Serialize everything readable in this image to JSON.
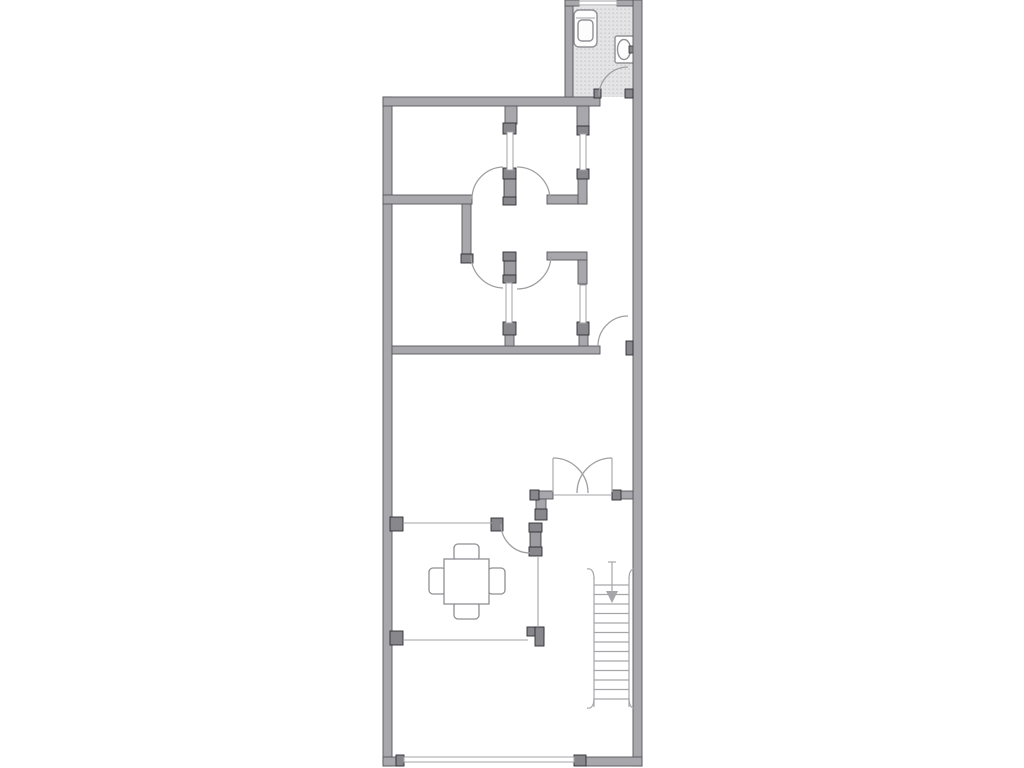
{
  "canvas": {
    "width": 1024,
    "height": 768,
    "background": "#ffffff"
  },
  "palette": {
    "wall": "#a8a8ac",
    "wall_outline": "#56565c",
    "jamb": "#87878c",
    "jamb_outline": "#2e2e33",
    "leaf": "#9c9ca1",
    "thin": "#a3a3a7",
    "arc": "#a0a0a4",
    "stair": "#a6a6aa",
    "fixture": "#909095",
    "fixture_fill": "#fdfdfe",
    "floor": "#e4e4e7",
    "floor_dot": "#c9c9cc"
  },
  "floor_plan": {
    "walls": [
      {
        "name": "exterior-wall-left",
        "x": 383,
        "y": 97,
        "w": 9,
        "h": 669
      },
      {
        "name": "exterior-wall-top",
        "x": 383,
        "y": 97,
        "w": 217,
        "h": 9
      },
      {
        "name": "exterior-wall-right",
        "x": 633,
        "y": 0,
        "w": 9,
        "h": 766
      },
      {
        "name": "exterior-wall-bottom-left",
        "x": 383,
        "y": 757,
        "w": 20,
        "h": 9
      },
      {
        "name": "exterior-wall-bottom-right",
        "x": 585,
        "y": 757,
        "w": 57,
        "h": 9
      },
      {
        "name": "bathroom-wall-left",
        "x": 565,
        "y": 0,
        "w": 8,
        "h": 97
      },
      {
        "name": "bathroom-wall-top-left",
        "x": 565,
        "y": 0,
        "w": 14,
        "h": 6
      },
      {
        "name": "bathroom-wall-top-right",
        "x": 617,
        "y": 0,
        "w": 16,
        "h": 6
      },
      {
        "name": "room1-south-wall",
        "x": 383,
        "y": 195,
        "w": 89,
        "h": 9
      },
      {
        "name": "corridor-west-wall",
        "x": 462,
        "y": 204,
        "w": 9,
        "h": 50
      },
      {
        "name": "hall-east-wall-upper",
        "x": 547,
        "y": 195,
        "w": 40,
        "h": 9
      },
      {
        "name": "hall-east-wall-upper-vert",
        "x": 578,
        "y": 178,
        "w": 9,
        "h": 26
      },
      {
        "name": "hall-east-wall-lower",
        "x": 547,
        "y": 252,
        "w": 40,
        "h": 8
      },
      {
        "name": "hall-east-wall-lower-vert",
        "x": 578,
        "y": 260,
        "w": 9,
        "h": 24
      },
      {
        "name": "corridor-south-wall",
        "x": 392,
        "y": 346,
        "w": 208,
        "h": 8
      },
      {
        "name": "french-door-wall-west",
        "x": 530,
        "y": 491,
        "w": 23,
        "h": 8
      },
      {
        "name": "french-door-wall-east",
        "x": 612,
        "y": 491,
        "w": 21,
        "h": 8
      },
      {
        "name": "french-door-wall-west-vert",
        "x": 536,
        "y": 499,
        "w": 10,
        "h": 13
      }
    ],
    "stubs": [
      {
        "name": "partition-stub-upper-left",
        "x": 505,
        "y": 106,
        "w": 12,
        "h": 18
      },
      {
        "name": "partition-stub-upper-right",
        "x": 577,
        "y": 106,
        "w": 12,
        "h": 21
      },
      {
        "name": "partition-foot-lower-left",
        "x": 505,
        "y": 334,
        "w": 9,
        "h": 12
      },
      {
        "name": "partition-foot-lower-right",
        "x": 579,
        "y": 334,
        "w": 9,
        "h": 12
      }
    ],
    "jambs": [
      {
        "name": "jamb-upper-left-partition",
        "x": 503,
        "y": 123,
        "w": 13,
        "h": 11
      },
      {
        "name": "jamb-upper-right-partition",
        "x": 577,
        "y": 126,
        "w": 12,
        "h": 9
      },
      {
        "name": "jamb-upper-right-partition2",
        "x": 577,
        "y": 169,
        "w": 12,
        "h": 10
      },
      {
        "name": "jamb-corridor-west-cap",
        "x": 461,
        "y": 254,
        "w": 12,
        "h": 9
      },
      {
        "name": "jamb-upper-post-top",
        "x": 503,
        "y": 168,
        "w": 13,
        "h": 11
      },
      {
        "name": "jamb-upper-post-bottom",
        "x": 503,
        "y": 197,
        "w": 13,
        "h": 8
      },
      {
        "name": "jamb-lower-post-top",
        "x": 503,
        "y": 252,
        "w": 13,
        "h": 9
      },
      {
        "name": "jamb-lower-post-bottom",
        "x": 503,
        "y": 275,
        "w": 13,
        "h": 8
      },
      {
        "name": "jamb-lower-left-foot",
        "x": 503,
        "y": 322,
        "w": 13,
        "h": 13
      },
      {
        "name": "jamb-lower-right-foot",
        "x": 577,
        "y": 322,
        "w": 12,
        "h": 13
      },
      {
        "name": "jamb-dining-line-left",
        "x": 390,
        "y": 517,
        "w": 13,
        "h": 14
      },
      {
        "name": "jamb-dining-line-right",
        "x": 491,
        "y": 518,
        "w": 12,
        "h": 13
      },
      {
        "name": "jamb-dining-leaf-top",
        "x": 529,
        "y": 523,
        "w": 13,
        "h": 9
      },
      {
        "name": "jamb-dining-leaf-bottom",
        "x": 529,
        "y": 547,
        "w": 13,
        "h": 9
      },
      {
        "name": "jamb-french-west-vert-cap",
        "x": 535,
        "y": 509,
        "w": 12,
        "h": 11
      },
      {
        "name": "jamb-french-west-end",
        "x": 530,
        "y": 490,
        "w": 9,
        "h": 10
      },
      {
        "name": "jamb-french-east-end",
        "x": 612,
        "y": 490,
        "w": 9,
        "h": 10
      },
      {
        "name": "jamb-lower-line-left",
        "x": 390,
        "y": 631,
        "w": 13,
        "h": 14
      },
      {
        "name": "jamb-dining-corner-h",
        "x": 527,
        "y": 627,
        "w": 17,
        "h": 9
      },
      {
        "name": "jamb-dining-corner-v",
        "x": 535,
        "y": 627,
        "w": 9,
        "h": 19
      },
      {
        "name": "jamb-bottom-window-left",
        "x": 396,
        "y": 755,
        "w": 8,
        "h": 11
      },
      {
        "name": "jamb-bottom-window-right",
        "x": 574,
        "y": 755,
        "w": 12,
        "h": 11
      },
      {
        "name": "jamb-bath-door-left",
        "x": 594,
        "y": 89,
        "w": 7,
        "h": 9
      },
      {
        "name": "jamb-bath-door-right",
        "x": 625,
        "y": 89,
        "w": 8,
        "h": 9
      },
      {
        "name": "jamb-corridor-door",
        "x": 626,
        "y": 341,
        "w": 7,
        "h": 14
      }
    ],
    "leaves": [
      {
        "name": "door-leaf-upper-pair",
        "x": 504,
        "y": 178,
        "w": 12,
        "h": 20
      },
      {
        "name": "door-leaf-lower-pair",
        "x": 504,
        "y": 260,
        "w": 12,
        "h": 16
      },
      {
        "name": "door-leaf-dining",
        "x": 530,
        "y": 531,
        "w": 11,
        "h": 17
      }
    ],
    "windows": [
      {
        "name": "interior-window-upper-left",
        "x": 507,
        "y": 132,
        "w": 6,
        "h": 38
      },
      {
        "name": "interior-window-upper-right",
        "x": 580,
        "y": 134,
        "w": 6,
        "h": 36
      },
      {
        "name": "interior-window-lower-left",
        "x": 506,
        "y": 283,
        "w": 6,
        "h": 40
      },
      {
        "name": "interior-window-lower-right",
        "x": 580,
        "y": 285,
        "w": 6,
        "h": 38
      },
      {
        "name": "bathroom-window",
        "x": 579,
        "y": 1,
        "w": 38,
        "h": 4
      },
      {
        "name": "bottom-window",
        "x": 404,
        "y": 757,
        "w": 170,
        "h": 5
      }
    ],
    "thin_lines": [
      {
        "name": "dining-open-line-top",
        "x1": 403,
        "y1": 523,
        "x2": 492,
        "y2": 523
      },
      {
        "name": "dining-open-line-right",
        "x1": 538,
        "y1": 556,
        "x2": 538,
        "y2": 627
      },
      {
        "name": "dining-open-line-bottom",
        "x1": 403,
        "y1": 640,
        "x2": 528,
        "y2": 640
      },
      {
        "name": "french-door-threshold",
        "x1": 553,
        "y1": 495,
        "x2": 612,
        "y2": 495
      },
      {
        "name": "french-door-leaf-left",
        "x1": 553,
        "y1": 458,
        "x2": 553,
        "y2": 492
      },
      {
        "name": "french-door-leaf-right",
        "x1": 612,
        "y1": 458,
        "x2": 612,
        "y2": 492
      }
    ],
    "door_arcs": [
      {
        "name": "bathroom-door-arc",
        "d": "M 599 96 A 29 29 0 0 1 628 67"
      },
      {
        "name": "upper-left-door-arc",
        "d": "M 472 199 A 32 32 0 0 1 503 167"
      },
      {
        "name": "upper-right-door-arc",
        "d": "M 517 167 A 33 33 0 0 1 550 199"
      },
      {
        "name": "lower-left-door-arc",
        "d": "M 503 288 A 33 33 0 0 1 471 256"
      },
      {
        "name": "lower-right-door-arc",
        "d": "M 551 256 A 34 34 0 0 1 517 289"
      },
      {
        "name": "corridor-door-arc",
        "d": "M 598 346 A 30 30 0 0 1 628 316"
      },
      {
        "name": "french-door-arc-left",
        "d": "M 553 458 A 35 35 0 0 1 588 493"
      },
      {
        "name": "french-door-arc-right",
        "d": "M 577 493 A 35 35 0 0 1 612 458"
      },
      {
        "name": "dining-door-arc",
        "d": "M 501 524 A 29 29 0 0 0 530 553"
      }
    ],
    "stairs": {
      "rail_left_x": 594,
      "rail_right_x": 629,
      "top_y": 577,
      "bottom_y": 707,
      "tread_first_y": 585,
      "tread_step": 9.5,
      "tread_count": 13,
      "hooks": [
        "M 594 579 C 594 571 591 568 587 569",
        "M 629 579 C 629 571 632 568 636 569",
        "M 594 698 C 594 706 591 709 587 708",
        "M 629 698 C 629 706 632 709 636 708"
      ],
      "arrow": {
        "line": {
          "x1": 612,
          "y1": 562,
          "x2": 612,
          "y2": 593
        },
        "head_points": "606,591 618,591 612,603",
        "tick": {
          "x1": 608,
          "y1": 562,
          "x2": 616,
          "y2": 562
        }
      }
    },
    "bathroom": {
      "floor": {
        "x": 573,
        "y": 6,
        "w": 60,
        "h": 91
      },
      "toilet": {
        "outer": {
          "x": 574,
          "y": 10,
          "w": 23,
          "h": 37,
          "r": 5
        },
        "inner": {
          "x": 578,
          "y": 20,
          "w": 15,
          "h": 21,
          "r": 4
        },
        "tank_line": {
          "x1": 576,
          "y1": 18,
          "x2": 595,
          "y2": 18
        }
      },
      "sink": {
        "rect": {
          "x": 615,
          "y": 36,
          "w": 19,
          "h": 27,
          "r": 2
        },
        "basin": {
          "cx": 624,
          "cy": 49.5,
          "rx": 6.5,
          "ry": 10
        },
        "tap": {
          "x": 629,
          "y": 46,
          "w": 5,
          "h": 7
        }
      }
    },
    "dining": {
      "table": {
        "x": 444,
        "y": 559,
        "w": 45,
        "h": 45
      },
      "chairs": [
        {
          "name": "chair-top",
          "x": 454,
          "y": 544,
          "w": 25,
          "h": 17,
          "r": 4
        },
        {
          "name": "chair-bottom",
          "x": 454,
          "y": 602,
          "w": 25,
          "h": 17,
          "r": 4
        },
        {
          "name": "chair-left",
          "x": 429,
          "y": 568,
          "w": 17,
          "h": 26,
          "r": 4
        },
        {
          "name": "chair-right",
          "x": 488,
          "y": 568,
          "w": 17,
          "h": 26,
          "r": 4
        }
      ]
    }
  }
}
